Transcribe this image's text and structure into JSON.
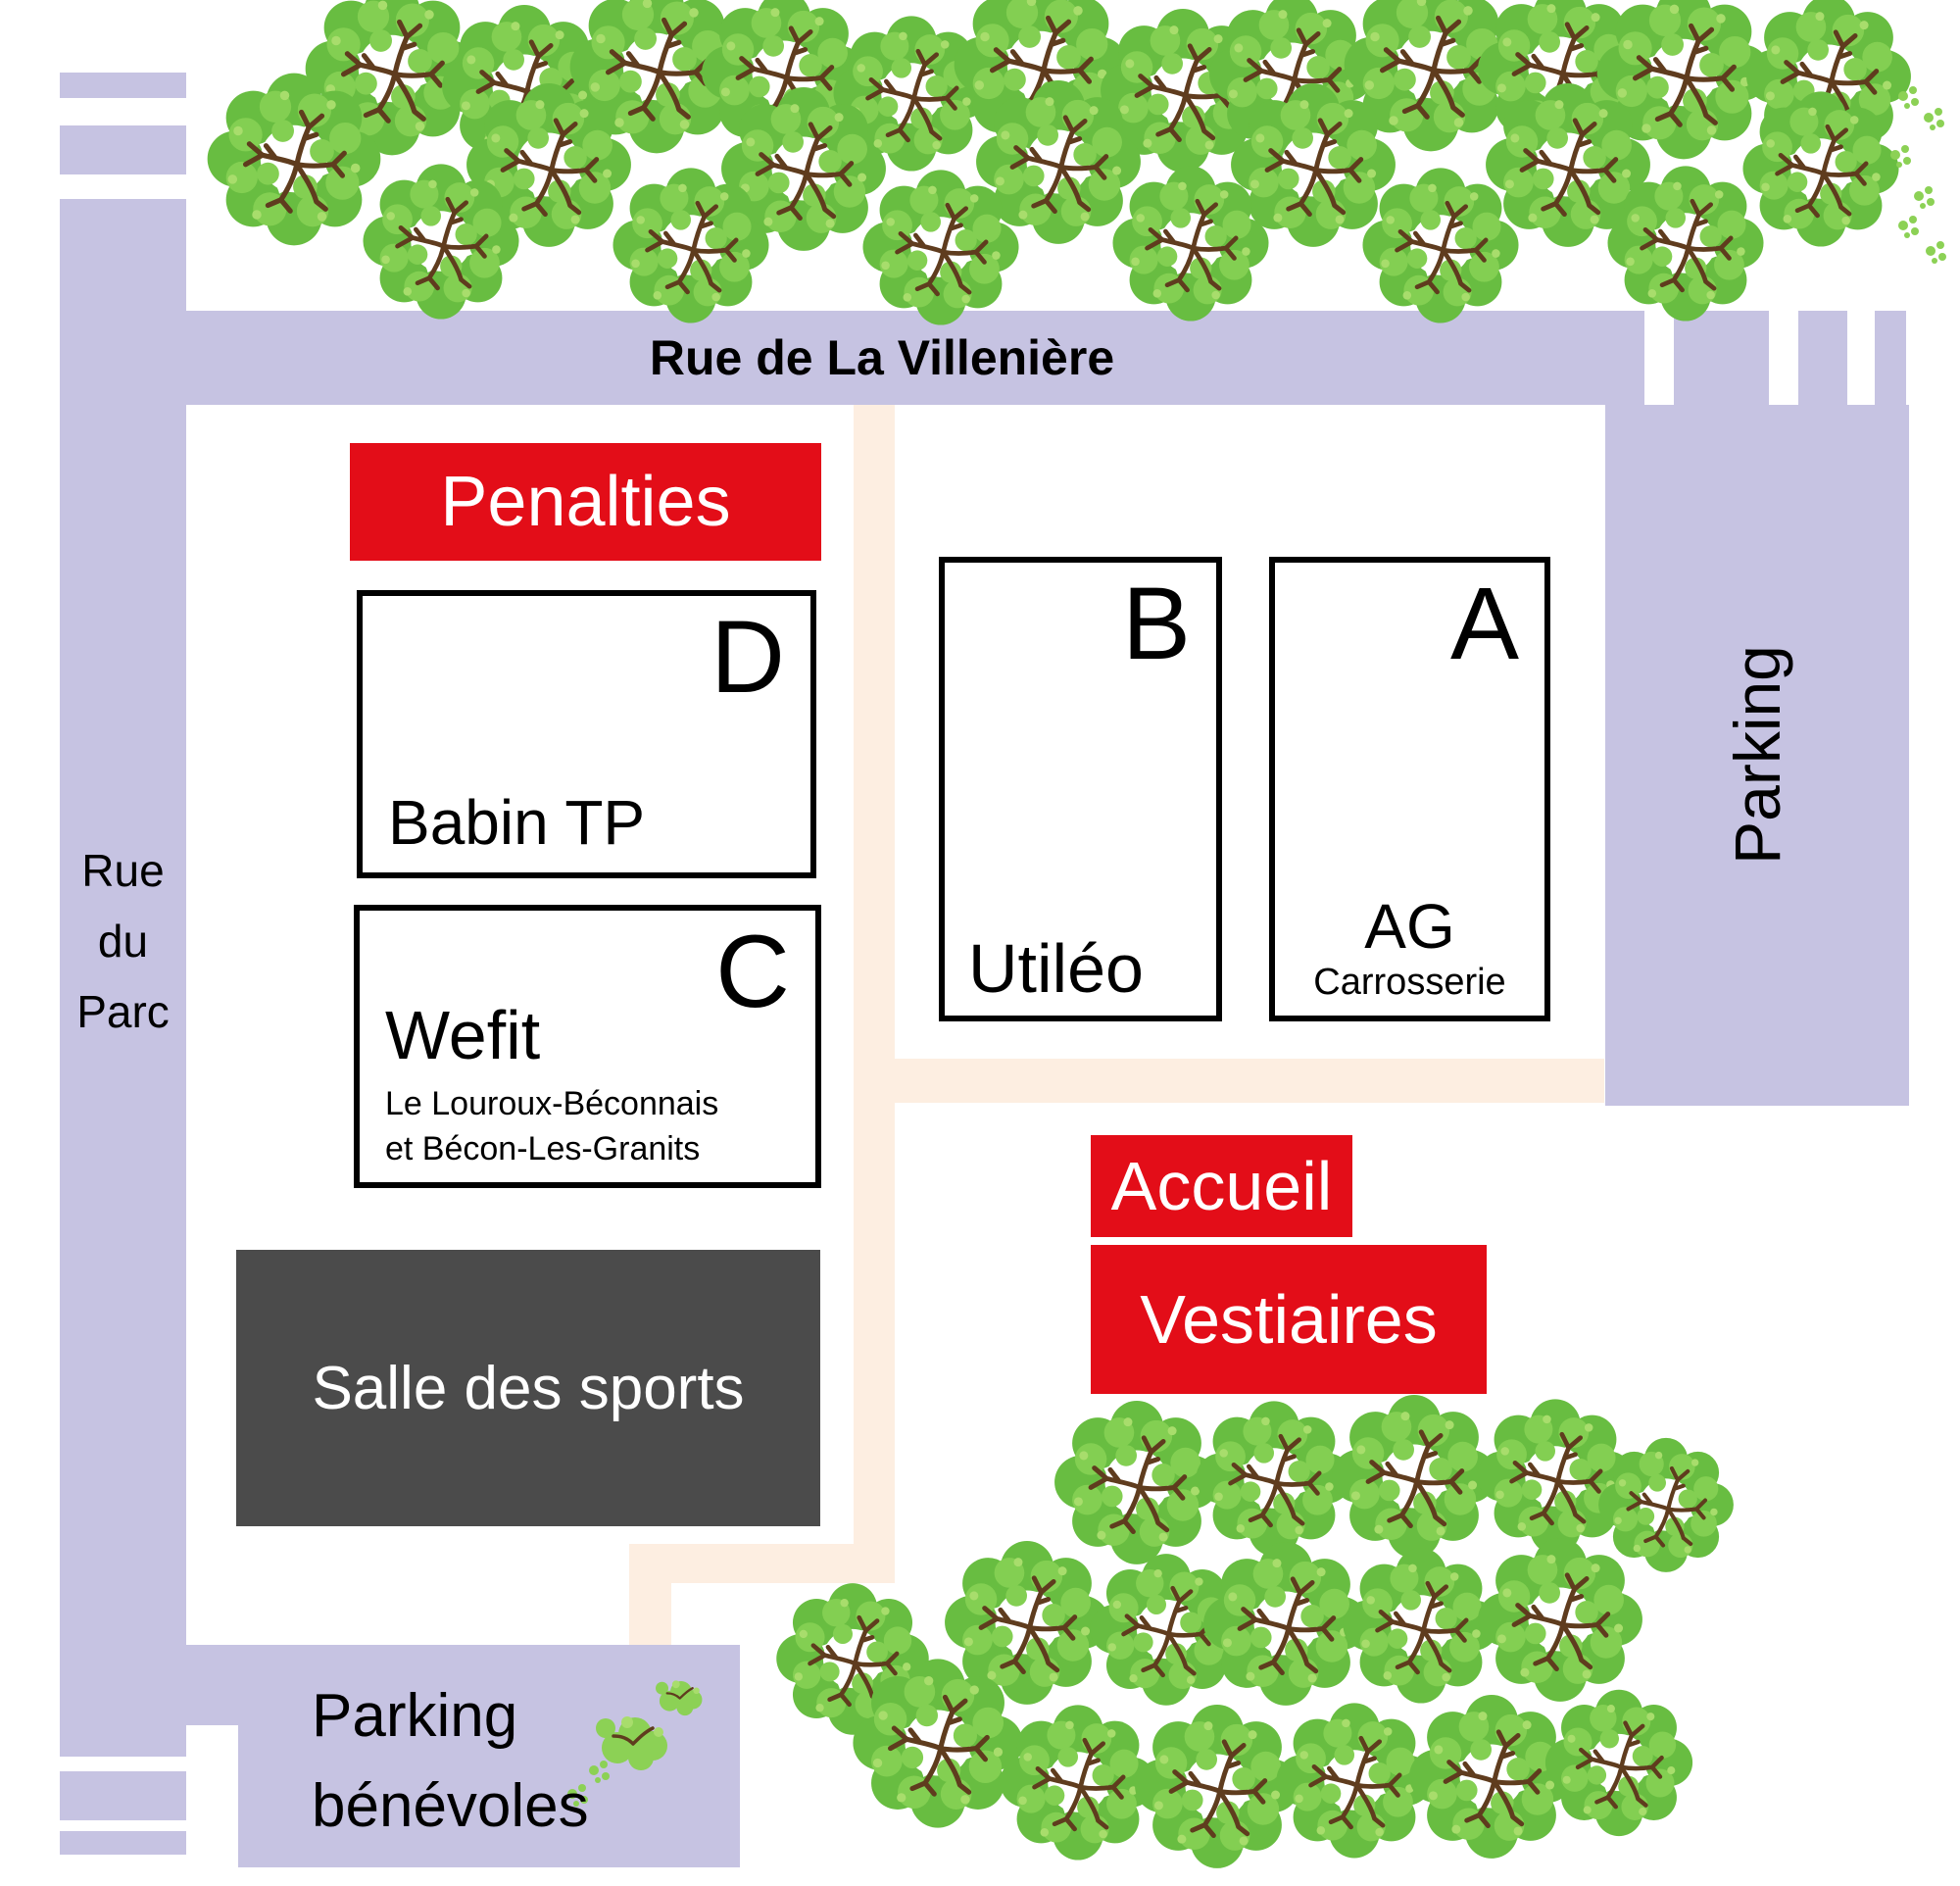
{
  "map": {
    "title": "site plan",
    "streets": {
      "rue_villeniere": "Rue de La Villenière",
      "rue_du_parc_lines": [
        "Rue",
        "du",
        "Parc"
      ]
    },
    "areas": {
      "parking_right": "Parking",
      "parking_benevoles_lines": [
        "Parking",
        "bénévoles"
      ],
      "salle": "Salle des sports"
    },
    "banners": {
      "penalties": "Penalties",
      "accueil": "Accueil",
      "vestiaires": "Vestiaires"
    },
    "buildings": {
      "d": {
        "letter": "D",
        "name": "Babin TP"
      },
      "c": {
        "letter": "C",
        "name": "Wefit",
        "sub1": "Le Louroux-Béconnais",
        "sub2": "et Bécon-Les-Granits"
      },
      "b": {
        "letter": "B",
        "name": "Utiléo"
      },
      "a": {
        "letter": "A",
        "name": "AG",
        "sub": "Carrosserie"
      }
    },
    "colors": {
      "road": "#c6c3e2",
      "accent_red": "#e30d18",
      "dark_gray": "#4b4b4b",
      "footpath": "#fdeee1",
      "tree_green": "#68bd41",
      "tree_light": "#83cf52",
      "branch_brown": "#5f3c1e"
    },
    "trees": {
      "top": [
        [
          400,
          70,
          1
        ],
        [
          535,
          88,
          0.95
        ],
        [
          670,
          68,
          1
        ],
        [
          800,
          74,
          0.95
        ],
        [
          930,
          95,
          0.9
        ],
        [
          1062,
          66,
          1
        ],
        [
          1207,
          92,
          0.95
        ],
        [
          1318,
          76,
          0.95
        ],
        [
          1460,
          66,
          1
        ],
        [
          1592,
          70,
          0.95
        ],
        [
          1718,
          74,
          1
        ],
        [
          1866,
          78,
          0.95
        ],
        [
          300,
          162,
          1
        ],
        [
          560,
          168,
          0.95
        ],
        [
          820,
          172,
          0.95
        ],
        [
          1080,
          165,
          0.95
        ],
        [
          1340,
          168,
          0.95
        ],
        [
          1600,
          168,
          0.95
        ],
        [
          1858,
          172,
          0.9
        ],
        [
          450,
          246,
          0.9
        ],
        [
          705,
          250,
          0.9
        ],
        [
          960,
          252,
          0.9
        ],
        [
          1215,
          248,
          0.9
        ],
        [
          1470,
          250,
          0.9
        ],
        [
          1720,
          248,
          0.9
        ]
      ],
      "bottom": [
        [
          1160,
          1512,
          0.95
        ],
        [
          1300,
          1508,
          0.9
        ],
        [
          1443,
          1506,
          0.95
        ],
        [
          1587,
          1506,
          0.9
        ],
        [
          1700,
          1535,
          0.78
        ],
        [
          1048,
          1655,
          0.95
        ],
        [
          1190,
          1662,
          0.88
        ],
        [
          1312,
          1656,
          0.95
        ],
        [
          1450,
          1658,
          0.9
        ],
        [
          1592,
          1652,
          0.95
        ],
        [
          870,
          1692,
          0.88
        ],
        [
          957,
          1778,
          0.98
        ],
        [
          1100,
          1818,
          0.9
        ],
        [
          1242,
          1822,
          0.95
        ],
        [
          1382,
          1816,
          0.9
        ],
        [
          1522,
          1812,
          0.95
        ],
        [
          1652,
          1798,
          0.85
        ]
      ],
      "sprouts": [
        [
          648,
          1775,
          1
        ],
        [
          695,
          1730,
          0.65
        ]
      ],
      "sprigs": [
        [
          1948,
          98
        ],
        [
          1974,
          120
        ],
        [
          1940,
          158
        ],
        [
          1964,
          200
        ],
        [
          1948,
          230
        ],
        [
          1976,
          256
        ],
        [
          612,
          1806
        ],
        [
          590,
          1830
        ]
      ]
    }
  }
}
